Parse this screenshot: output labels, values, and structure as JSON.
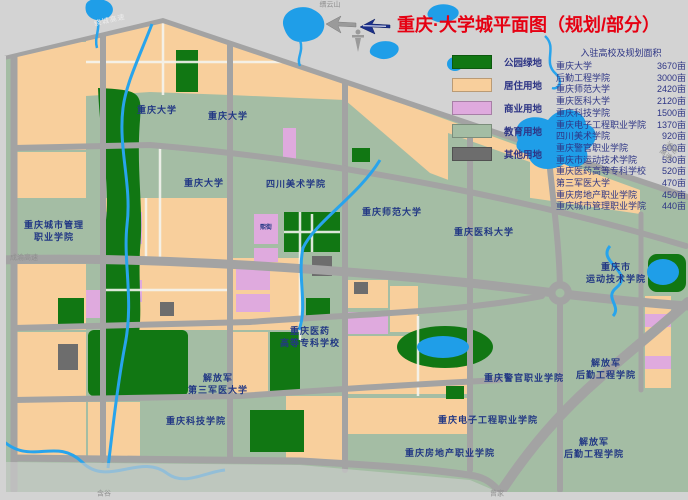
{
  "title": {
    "text": "重庆·大学城平面图（规划/部分）"
  },
  "colors": {
    "margin": "#d3d3d3",
    "road": "#a3a3a3",
    "education": "#a4bda4",
    "residential": "#f8cf9c",
    "commercial": "#dfaade",
    "park": "#117713",
    "other": "#6d6d6d",
    "water": "#1f9ee8",
    "title_red": "#e60012",
    "label_navy": "#223884"
  },
  "legend": {
    "items": [
      {
        "label": "公园绿地",
        "color": "#117713"
      },
      {
        "label": "居住用地",
        "color": "#f8cf9c"
      },
      {
        "label": "商业用地",
        "color": "#dfaade"
      },
      {
        "label": "教育用地",
        "color": "#a4bda4"
      },
      {
        "label": "其他用地",
        "color": "#6d6d6d"
      }
    ]
  },
  "schools": {
    "header": "入驻高校及规划面积",
    "rows": [
      {
        "name": "重庆大学",
        "area": "3670亩"
      },
      {
        "name": "后勤工程学院",
        "area": "3000亩"
      },
      {
        "name": "重庆师范大学",
        "area": "2420亩"
      },
      {
        "name": "重庆医科大学",
        "area": "2120亩"
      },
      {
        "name": "重庆科技学院",
        "area": "1500亩"
      },
      {
        "name": "重庆电子工程职业学院",
        "area": "1370亩"
      },
      {
        "name": "四川美术学院",
        "area": "920亩"
      },
      {
        "name": "重庆警官职业学院",
        "area": "600亩"
      },
      {
        "name": "重庆市运动技术学院",
        "area": "530亩"
      },
      {
        "name": "重庆医药高等专科学校",
        "area": "520亩"
      },
      {
        "name": "第三军医大学",
        "area": "470亩"
      },
      {
        "name": "重庆房地产职业学院",
        "area": "450亩"
      },
      {
        "name": "重庆城市管理职业学院",
        "area": "440亩"
      }
    ]
  },
  "map_labels": [
    {
      "text": "重庆大学",
      "x": 157,
      "y": 110
    },
    {
      "text": "重庆大学",
      "x": 228,
      "y": 116
    },
    {
      "text": "重庆大学",
      "x": 204,
      "y": 183
    },
    {
      "text": "四川美术学院",
      "x": 296,
      "y": 184
    },
    {
      "text": "重庆师范大学",
      "x": 392,
      "y": 212
    },
    {
      "text": "重庆医科大学",
      "x": 484,
      "y": 232
    },
    {
      "text": "重庆城市管理\n职业学院",
      "x": 54,
      "y": 231
    },
    {
      "text": "熙街",
      "x": 266,
      "y": 228,
      "cls": "tiny"
    },
    {
      "text": "重庆医药\n高等专科学校",
      "x": 310,
      "y": 337
    },
    {
      "text": "解放军\n第三军医大学",
      "x": 218,
      "y": 384
    },
    {
      "text": "重庆科技学院",
      "x": 196,
      "y": 421
    },
    {
      "text": "重庆房地产职业学院",
      "x": 450,
      "y": 453
    },
    {
      "text": "重庆电子工程职业学院",
      "x": 488,
      "y": 420
    },
    {
      "text": "重庆警官职业学院",
      "x": 524,
      "y": 378
    },
    {
      "text": "重庆市\n运动技术学院",
      "x": 616,
      "y": 273
    },
    {
      "text": "解放军\n后勤工程学院",
      "x": 606,
      "y": 369
    },
    {
      "text": "解放军\n后勤工程学院",
      "x": 594,
      "y": 448
    }
  ],
  "edge_labels": [
    {
      "text": "绕城高速",
      "x": 110,
      "y": 21,
      "rot": -13,
      "cls": "on-road"
    },
    {
      "text": "缙云山",
      "x": 330,
      "y": 5,
      "cls": "terrain"
    },
    {
      "text": "渝遂高速",
      "x": 668,
      "y": 152,
      "rot": 42,
      "cls": "terrain"
    },
    {
      "text": "成渝高速",
      "x": 24,
      "y": 258,
      "cls": "terrain"
    },
    {
      "text": "含谷",
      "x": 104,
      "y": 494,
      "cls": "terrain"
    },
    {
      "text": "曾家",
      "x": 497,
      "y": 494,
      "cls": "terrain"
    }
  ]
}
